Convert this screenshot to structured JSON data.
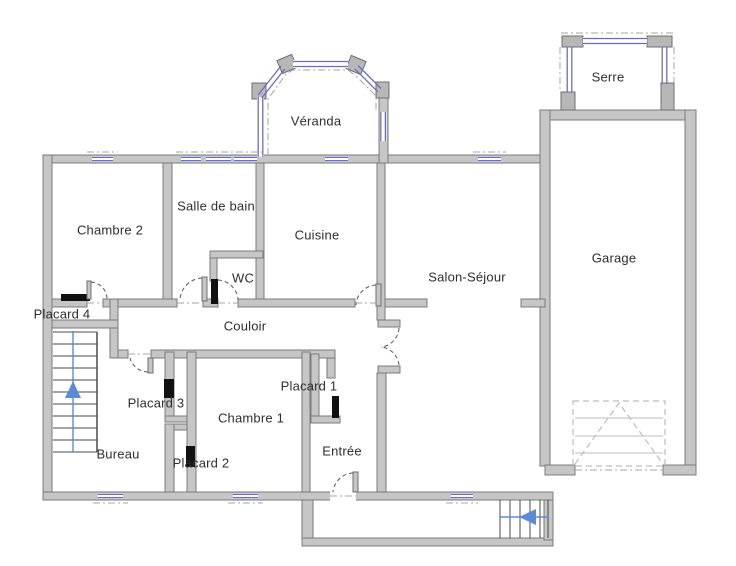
{
  "diagram": {
    "type": "floor-plan",
    "background": "#ffffff",
    "rooms": [
      {
        "id": "veranda",
        "label": "Véranda"
      },
      {
        "id": "serre",
        "label": "Serre"
      },
      {
        "id": "chambre2",
        "label": "Chambre 2"
      },
      {
        "id": "salle_de_bain",
        "label": "Salle de bain"
      },
      {
        "id": "cuisine",
        "label": "Cuisine"
      },
      {
        "id": "salon_sejour",
        "label": "Salon-Séjour"
      },
      {
        "id": "garage",
        "label": "Garage"
      },
      {
        "id": "wc",
        "label": "WC"
      },
      {
        "id": "couloir",
        "label": "Couloir"
      },
      {
        "id": "placard4",
        "label": "Placard 4"
      },
      {
        "id": "placard3",
        "label": "Placard 3"
      },
      {
        "id": "placard2",
        "label": "Placard 2"
      },
      {
        "id": "placard1",
        "label": "Placard 1"
      },
      {
        "id": "chambre1",
        "label": "Chambre 1"
      },
      {
        "id": "bureau",
        "label": "Bureau"
      },
      {
        "id": "entree",
        "label": "Entrée"
      }
    ],
    "colors": {
      "wall_fill": "#c6c6c6",
      "wall_stroke": "#7b7b7b",
      "window_blue": "#6b6bc4",
      "closet_door_black": "#111111",
      "door_arc": "#555555",
      "construction_dash": "#a5a5a5",
      "stairs_arrow_blue": "#5b8bd5",
      "garage_door_dash": "#bdbdbd"
    },
    "icons": {
      "interior_stairs_arrow": "triangle-up",
      "exterior_stairs_arrow": "triangle-left"
    }
  }
}
